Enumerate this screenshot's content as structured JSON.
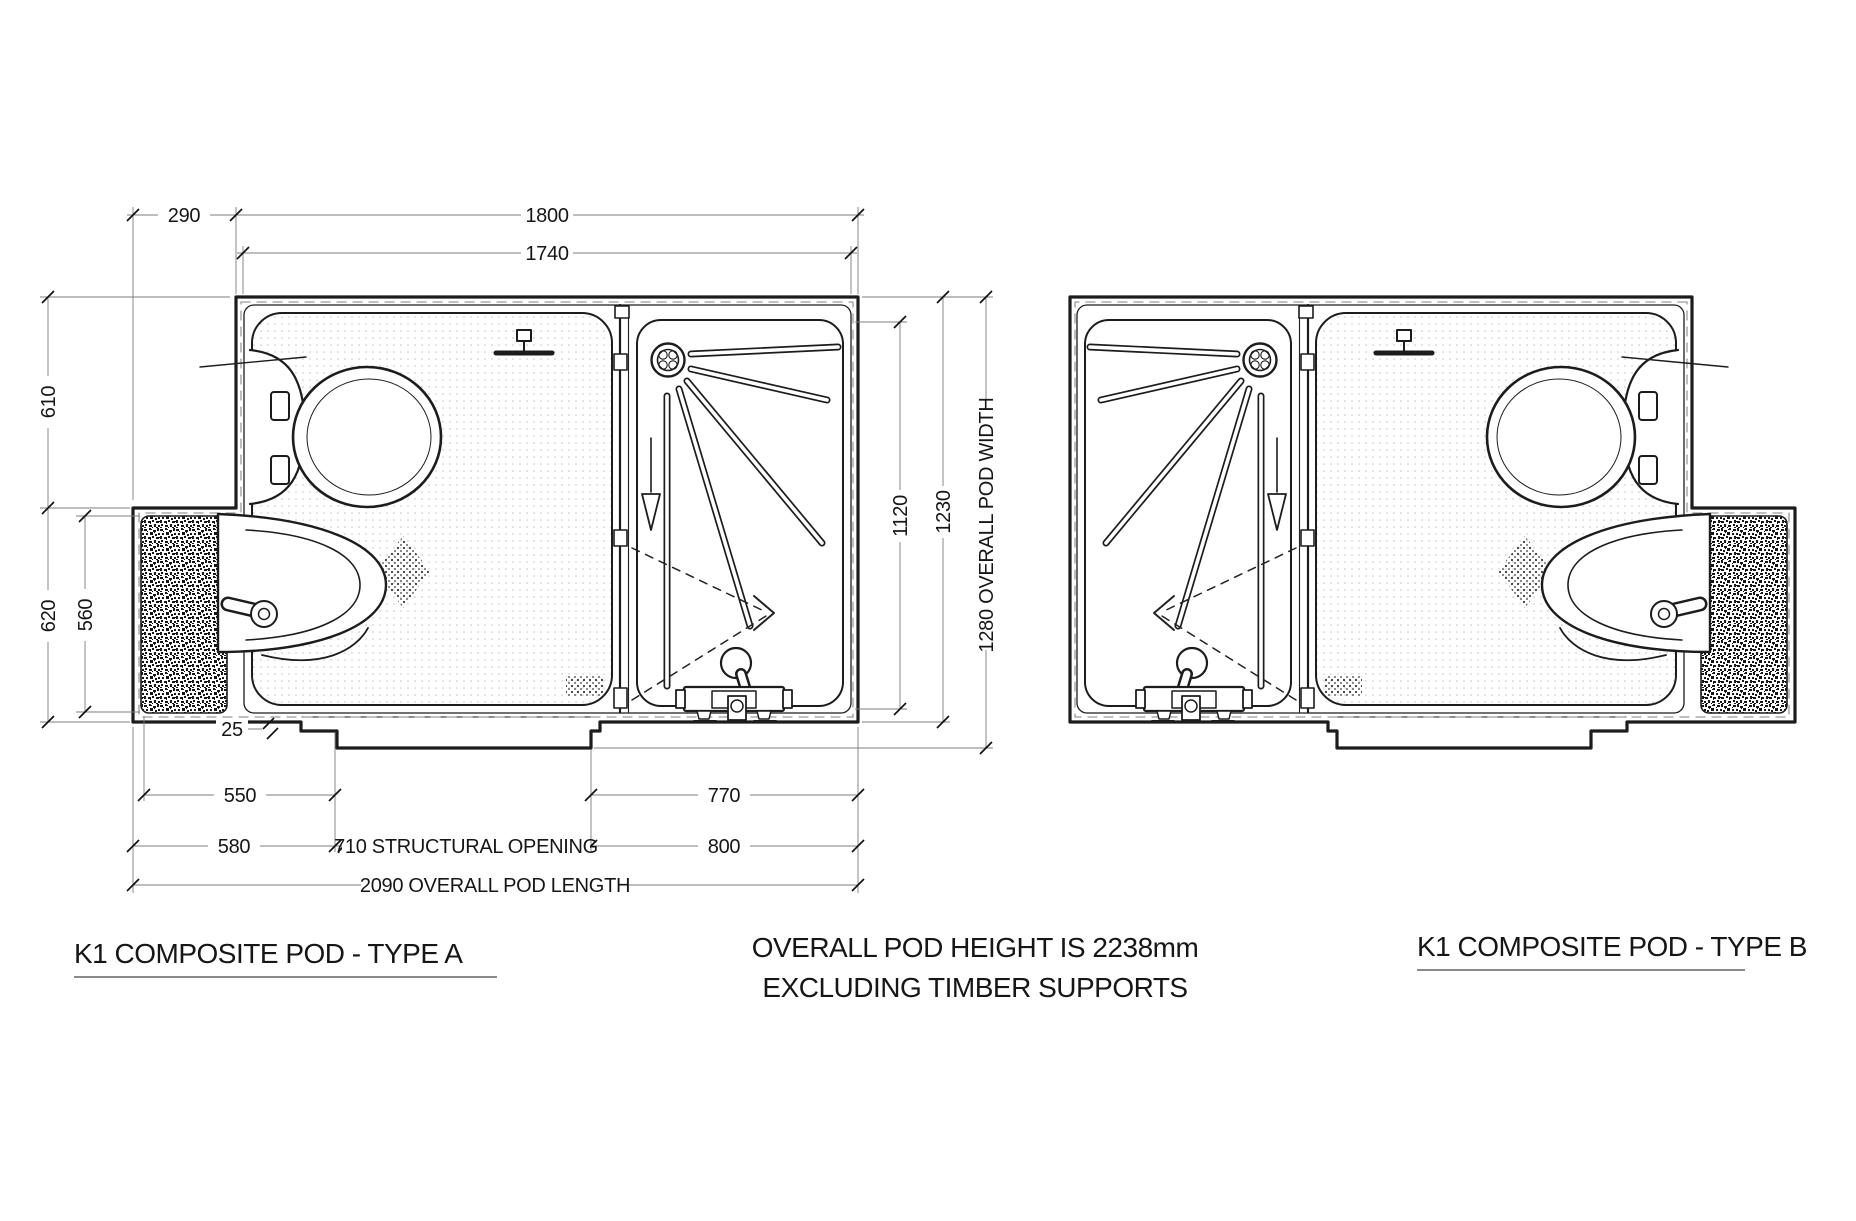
{
  "type_a": {
    "title": "K1 COMPOSITE POD - TYPE A",
    "dims": {
      "offset_290": "290",
      "overall_top_1800": "1800",
      "inner_top_1740": "1740",
      "left_610": "610",
      "left_620": "620",
      "left_560": "560",
      "right_1120": "1120",
      "right_1230": "1230",
      "right_overall": "1280 OVERALL POD WIDTH",
      "step_25": "25",
      "bottom_550": "550",
      "bottom_580": "580",
      "bottom_opening": "710 STRUCTURAL OPENING",
      "bottom_770": "770",
      "bottom_800": "800",
      "bottom_overall": "2090 OVERALL POD LENGTH"
    }
  },
  "type_b": {
    "title": "K1 COMPOSITE POD - TYPE B"
  },
  "note": {
    "line1": "OVERALL POD HEIGHT IS 2238mm",
    "line2": "EXCLUDING TIMBER SUPPORTS"
  },
  "colors": {
    "line": "#1c1c1c",
    "dash": "#9a9a9a",
    "dim_line": "#7d7d7d",
    "floor_dot": "#bfbfbf"
  }
}
